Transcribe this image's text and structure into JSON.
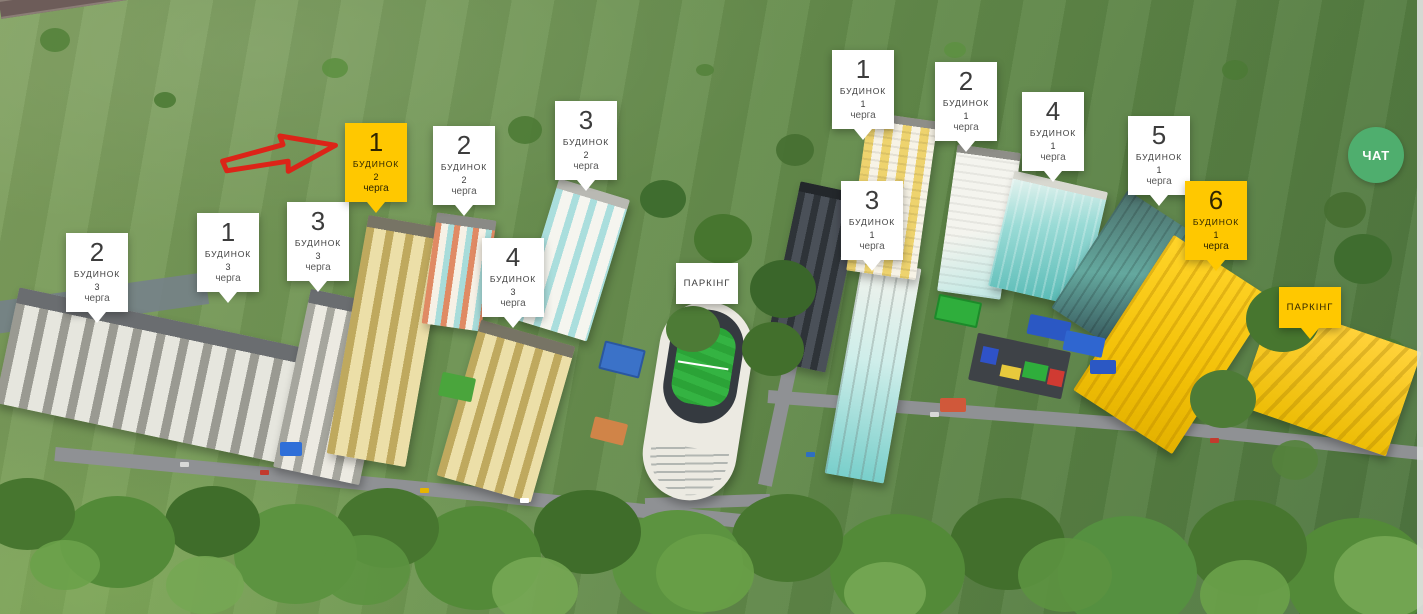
{
  "colors": {
    "highlight_yellow": "#ffc800",
    "chat_green": "#4fae6e",
    "arrow_red": "#dc2418",
    "card_white": "#ffffff"
  },
  "labels": [
    {
      "number": "2",
      "word": "БУДИНОК",
      "phase": "3",
      "cherga": "черга",
      "variant": "white"
    },
    {
      "number": "1",
      "word": "БУДИНОК",
      "phase": "3",
      "cherga": "черга",
      "variant": "white"
    },
    {
      "number": "3",
      "word": "БУДИНОК",
      "phase": "3",
      "cherga": "черга",
      "variant": "white"
    },
    {
      "number": "1",
      "word": "БУДИНОК",
      "phase": "2",
      "cherga": "черга",
      "variant": "yellow"
    },
    {
      "number": "2",
      "word": "БУДИНОК",
      "phase": "2",
      "cherga": "черга",
      "variant": "white"
    },
    {
      "number": "3",
      "word": "БУДИНОК",
      "phase": "2",
      "cherga": "черга",
      "variant": "white"
    },
    {
      "number": "4",
      "word": "БУДИНОК",
      "phase": "3",
      "cherga": "черга",
      "variant": "white"
    },
    {
      "number": "1",
      "word": "БУДИНОК",
      "phase": "1",
      "cherga": "черга",
      "variant": "white"
    },
    {
      "number": "2",
      "word": "БУДИНОК",
      "phase": "1",
      "cherga": "черга",
      "variant": "white"
    },
    {
      "number": "3",
      "word": "БУДИНОК",
      "phase": "1",
      "cherga": "черга",
      "variant": "white"
    },
    {
      "number": "4",
      "word": "БУДИНОК",
      "phase": "1",
      "cherga": "черга",
      "variant": "white"
    },
    {
      "number": "5",
      "word": "БУДИНОК",
      "phase": "1",
      "cherga": "черга",
      "variant": "white"
    },
    {
      "number": "6",
      "word": "БУДИНОК",
      "phase": "1",
      "cherga": "черга",
      "variant": "yellow"
    }
  ],
  "parking_labels": [
    {
      "text": "ПАРКІНГ",
      "variant": "white"
    },
    {
      "text": "ПАРКІНГ",
      "variant": "yellow"
    }
  ],
  "chat": {
    "label": "ЧАТ"
  }
}
